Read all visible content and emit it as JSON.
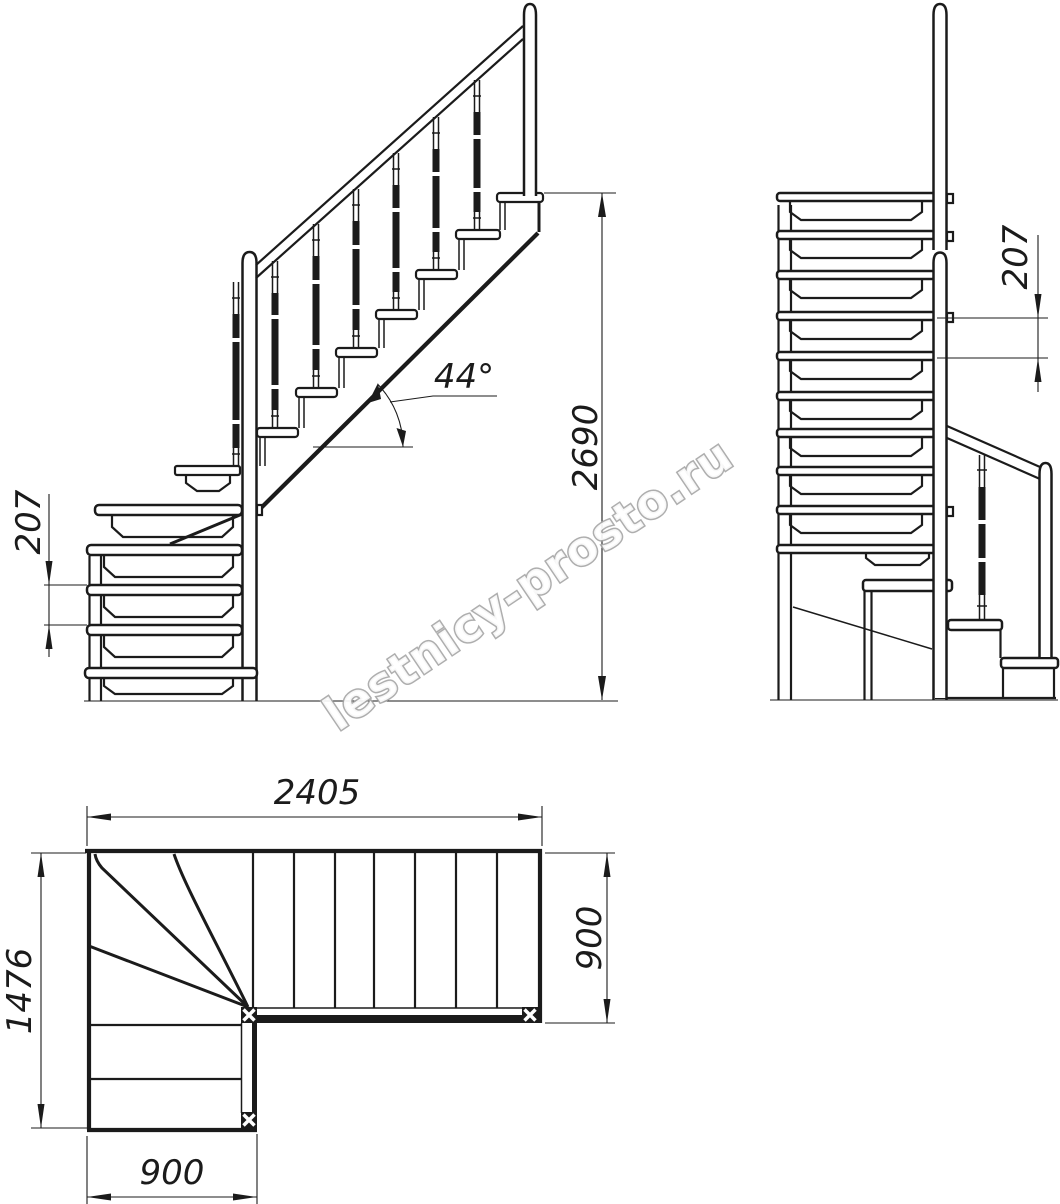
{
  "line_color": "#1b1b1b",
  "watermark": {
    "text": "lestnicy-prosto.ru",
    "color": "#a5a5a5"
  },
  "dimensions": {
    "front_step_rise": "207",
    "front_slope_angle": "44°",
    "front_total_height": "2690",
    "side_step_rise": "207",
    "plan_total_length": "2405",
    "plan_flight_width": "900",
    "plan_total_depth": "1476",
    "plan_lower_flight_width": "900"
  }
}
